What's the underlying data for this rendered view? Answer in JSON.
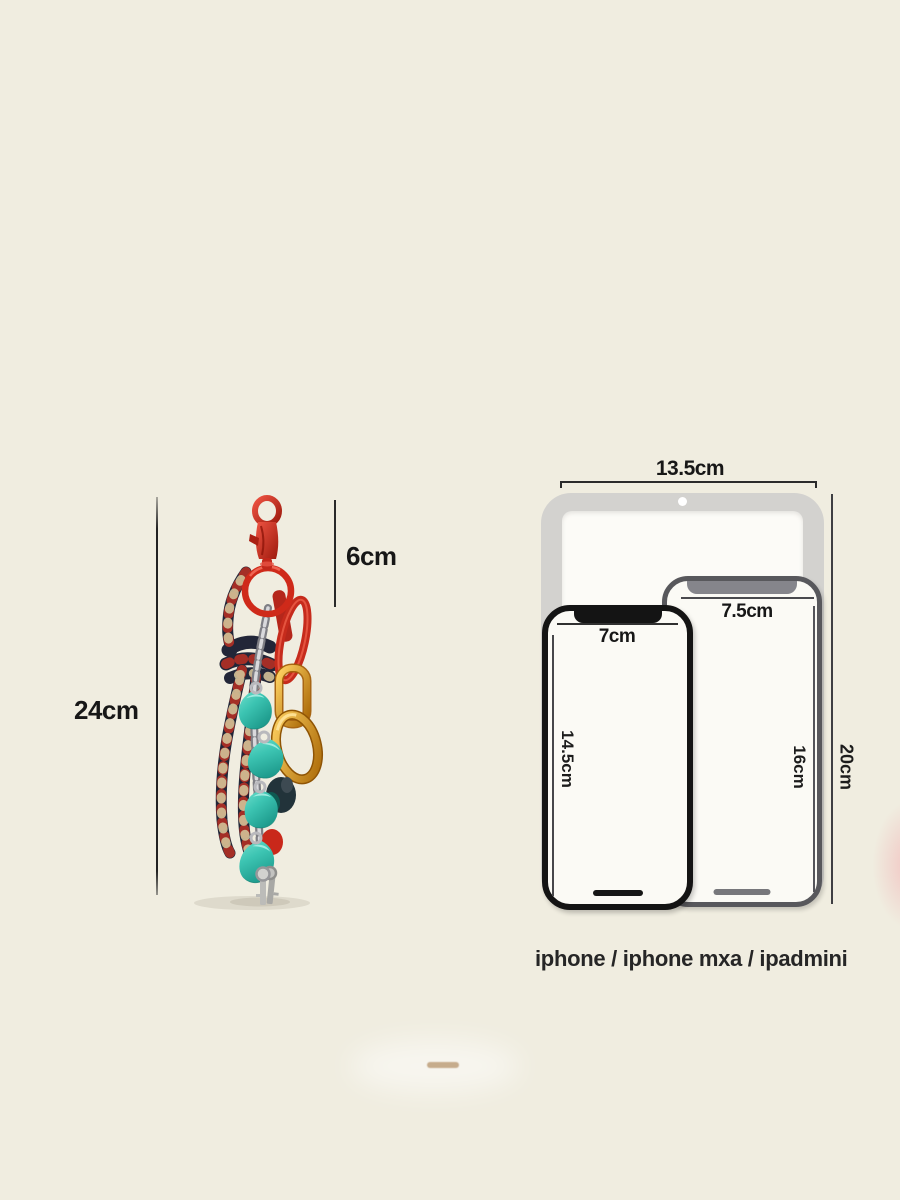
{
  "product_figure": {
    "total_height_label": "24cm",
    "clasp_height_label": "6cm"
  },
  "device_chart": {
    "ipad_width_label": "13.5cm",
    "ipad_height_label": "20cm",
    "phone_mxa_width_label": "7.5cm",
    "phone_mxa_height_label": "16cm",
    "phone_width_label": "7cm",
    "phone_height_label": "14.5cm",
    "caption": "iphone / iphone mxa / ipadmini"
  },
  "devices": [
    {
      "name": "iphone",
      "width": "7cm",
      "height": "14.5cm"
    },
    {
      "name": "iphone mxa",
      "width": "7.5cm",
      "height": "16cm"
    },
    {
      "name": "ipadmini",
      "width": "13.5cm",
      "height": "20cm"
    }
  ],
  "colors": {
    "background": "#f0ede0",
    "clasp_red": "#cf2a1a",
    "rope_navy": "#222638",
    "rope_fleck_red": "#bb3023",
    "rope_fleck_gold": "#d2c298",
    "charm_teal": "#3cc4b2",
    "carabiner_amber": "#c8820f",
    "chain_silver": "#a9a9ad",
    "ipad_gray": "#d3d2cf",
    "phone_frame_gray": "#58585c",
    "phone_frame_black": "#141414"
  }
}
